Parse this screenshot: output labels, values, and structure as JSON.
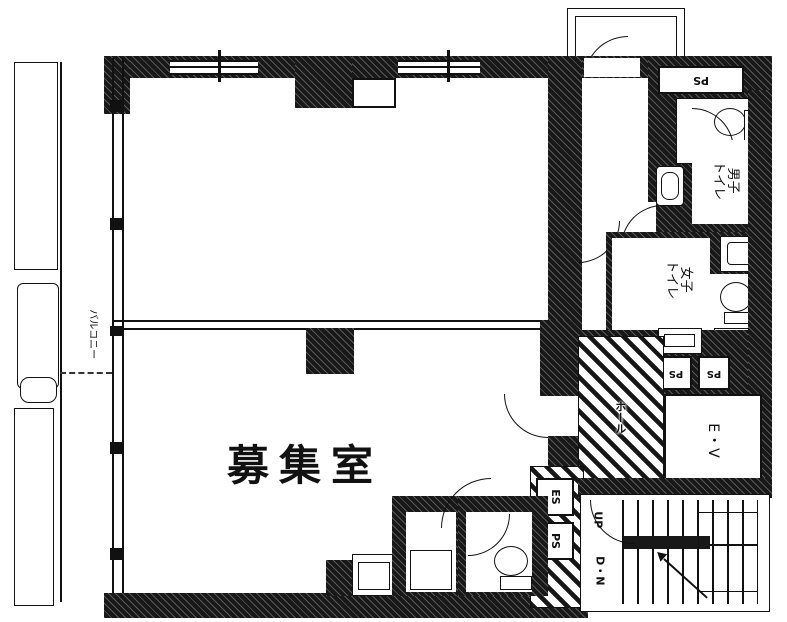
{
  "plan": {
    "main_room": "募集室",
    "balcony": "バルコニー",
    "hall_shaft": "ホール",
    "elevator": "E・V",
    "stairs_up": "UP",
    "stairs_down": "D・N",
    "es": "ES",
    "ps": "PS",
    "mens_toilet": {
      "line1": "男子",
      "line2": "トイレ"
    },
    "womens_toilet": {
      "line1": "女子",
      "line2": "トイレ"
    }
  },
  "colors": {
    "wall": "#181818",
    "line": "#111111",
    "background": "#ffffff"
  }
}
